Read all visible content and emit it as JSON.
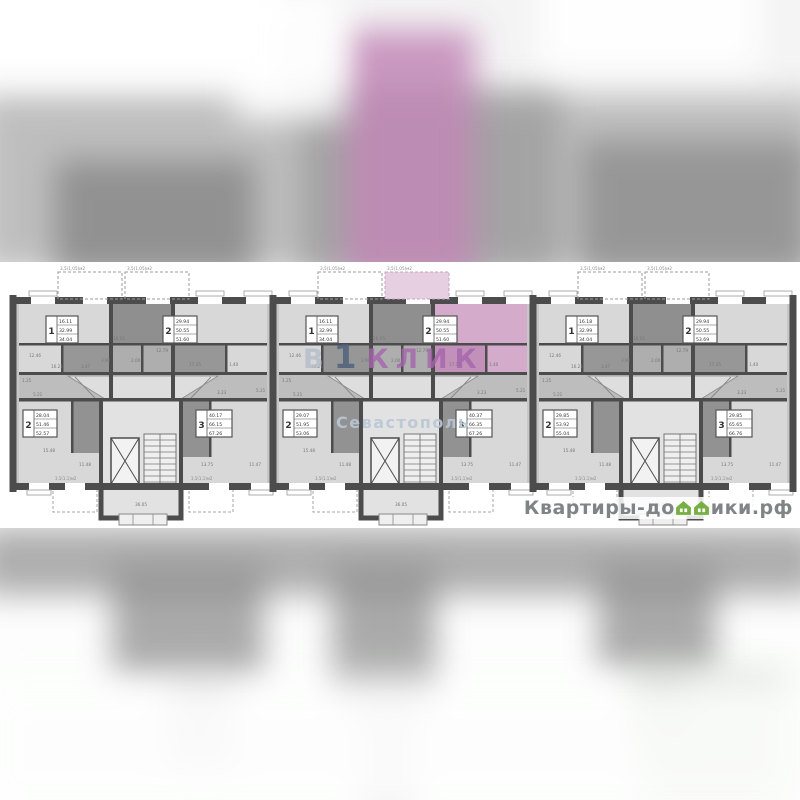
{
  "watermark": {
    "part1": "В",
    "part2": "1",
    "part3": "КЛИК",
    "subtitle": "Севастополь",
    "color_b": "#b3bdc9",
    "color_one": "#4e5f7a",
    "color_klik": "#a565ad",
    "color_subtitle": "#b9c7d5"
  },
  "logo": {
    "prefix": "Квартиры-до",
    "suffix": "ики.рф",
    "house_icon_color": "#76b043",
    "text_color": "#7f8487"
  },
  "plan": {
    "wall_color": "#4c4c4c",
    "room_light": "#d8d8d8",
    "room_mid": "#aeaeae",
    "room_dark": "#8f8f8f",
    "stair_fill": "#e2e2e2",
    "highlight_main": "#d5abcc",
    "highlight_dark": "#c291b9",
    "highlight_balcony": "#e6cfe0",
    "balcony_label": "3,5(1,05)м2",
    "porch_label": "3,5(1,1)м2",
    "sections": [
      {
        "id": "left",
        "apartments": [
          {
            "rooms": "1",
            "areas": [
              "16.11",
              "32.99",
              "34.04"
            ],
            "highlighted": false
          },
          {
            "rooms": "2",
            "areas": [
              "29.94",
              "50.55",
              "51.60"
            ],
            "highlighted": false
          },
          {
            "rooms": "2",
            "areas": [
              "28.04",
              "51.46",
              "52.57"
            ],
            "highlighted": false
          },
          {
            "rooms": "3",
            "areas": [
              "40.17",
              "66.15",
              "67.26"
            ],
            "highlighted": false
          }
        ]
      },
      {
        "id": "middle",
        "apartments": [
          {
            "rooms": "1",
            "areas": [
              "16.11",
              "32.99",
              "34.04"
            ],
            "highlighted": false
          },
          {
            "rooms": "2",
            "areas": [
              "29.94",
              "50.55",
              "51.60"
            ],
            "highlighted": true
          },
          {
            "rooms": "2",
            "areas": [
              "29.07",
              "51.95",
              "53.06"
            ],
            "highlighted": false
          },
          {
            "rooms": "3",
            "areas": [
              "40.37",
              "66.35",
              "67.26"
            ],
            "highlighted": false
          }
        ]
      },
      {
        "id": "right",
        "apartments": [
          {
            "rooms": "1",
            "areas": [
              "16.18",
              "32.99",
              "34.04"
            ],
            "highlighted": false
          },
          {
            "rooms": "2",
            "areas": [
              "29.94",
              "50.55",
              "53.69"
            ],
            "highlighted": false
          },
          {
            "rooms": "2",
            "areas": [
              "29.85",
              "53.92",
              "55.04"
            ],
            "highlighted": false
          },
          {
            "rooms": "3",
            "areas": [
              "29.85",
              "65.65",
              "66.76"
            ],
            "highlighted": false
          }
        ]
      }
    ],
    "section_annotations": [
      {
        "dx": 16,
        "y": 357,
        "t": "12.46"
      },
      {
        "dx": 9,
        "y": 382,
        "t": "1.25"
      },
      {
        "dx": 20,
        "y": 396,
        "t": "5.21"
      },
      {
        "dx": 38,
        "y": 368,
        "t": "16.21"
      },
      {
        "dx": 68,
        "y": 368,
        "t": "3.47"
      },
      {
        "dx": 88,
        "y": 362,
        "t": "3.90"
      },
      {
        "dx": 118,
        "y": 362,
        "t": "2.00"
      },
      {
        "dx": 100,
        "y": 340,
        "t": "16.05"
      },
      {
        "dx": 143,
        "y": 352,
        "t": "12.79"
      },
      {
        "dx": 176,
        "y": 366,
        "t": "17.15"
      },
      {
        "dx": 216,
        "y": 366,
        "t": "1.40"
      },
      {
        "dx": 204,
        "y": 394,
        "t": "3.23"
      },
      {
        "dx": 243,
        "y": 392,
        "t": "5.21"
      },
      {
        "dx": 30,
        "y": 452,
        "t": "15.48"
      },
      {
        "dx": 66,
        "y": 466,
        "t": "11.48"
      },
      {
        "dx": 188,
        "y": 466,
        "t": "13.75"
      },
      {
        "dx": 236,
        "y": 466,
        "t": "11.47"
      },
      {
        "dx": 122,
        "y": 506,
        "t": "36.05"
      }
    ]
  }
}
